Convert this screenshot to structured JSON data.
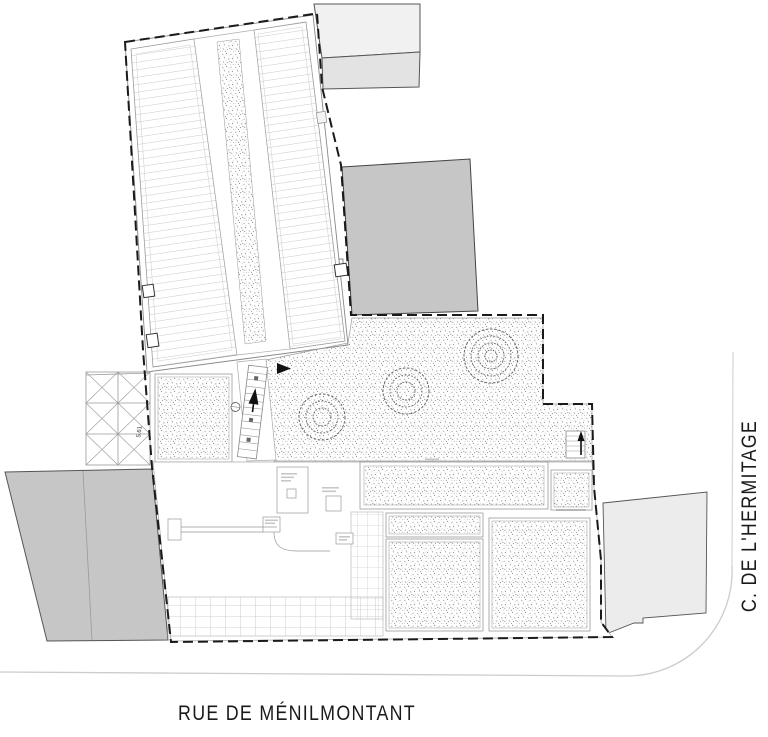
{
  "labels": {
    "street_bottom": "RUE DE MÉNILMONTANT",
    "street_right": "C. DE L'HERMITAGE",
    "dimension": "5.61"
  },
  "colors": {
    "background": "#ffffff",
    "neighbor_building_gray": "#c6c6c6",
    "neighbor_building_light": "#ececec",
    "neighbor_building_lighter": "#f1f1f1",
    "roof_hatch_line": "#c9c9c9",
    "boundary_line": "#1a1a1a",
    "garden_stipple": "#4a4a4a",
    "street_curb_line": "#cccccc",
    "street_text": "#1a1a1a"
  },
  "icons": {
    "north_up_arrow": "stair direction arrow",
    "entrance_arrow": "entrance direction triangle"
  }
}
